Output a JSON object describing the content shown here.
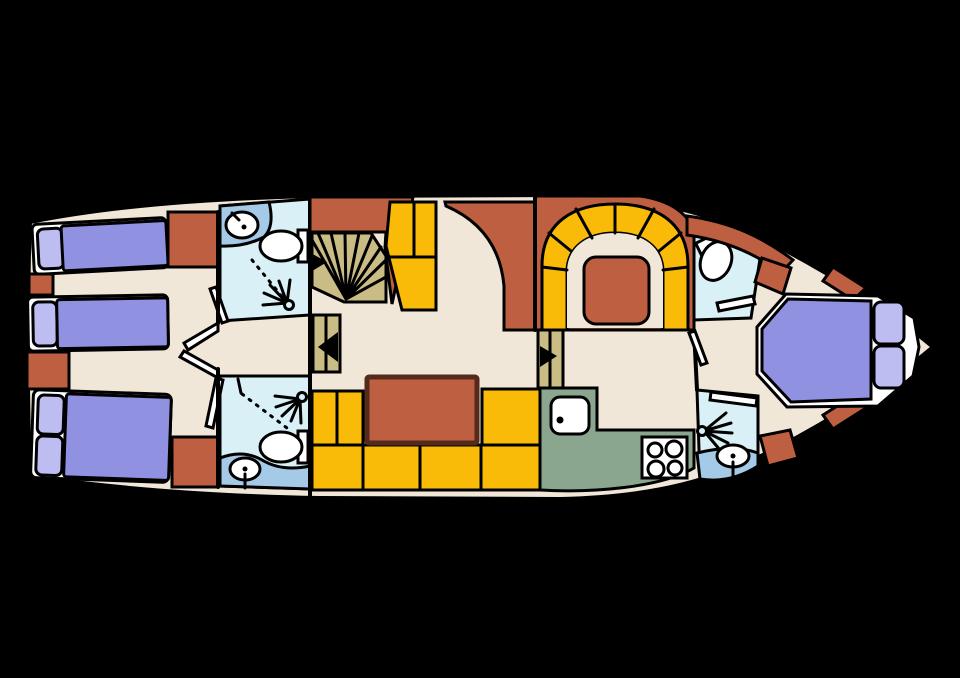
{
  "plan": {
    "type": "yacht-deck-floor-plan",
    "orientation": "bow-right",
    "rooms": [
      "aft cabin with two single berths and one double berth",
      "aft bathroom upper (sink, toilet, shower)",
      "aft bathroom lower (shower, toilet, sink)",
      "companionway stairs",
      "salon with U-sofa and table",
      "helm console",
      "dinette with horseshoe bench and table",
      "galley (sink, stove)",
      "forward bathroom upper (toilet)",
      "forward bathroom lower (shower, sink)",
      "bow cabin with double berth"
    ],
    "fixtures": [
      "bed",
      "pillow",
      "toilet",
      "sink",
      "shower-spray",
      "stove-4-burner",
      "fan-staircase",
      "step-treads",
      "door-leaf",
      "direction-arrow",
      "storage-block",
      "table"
    ]
  },
  "palette": {
    "background": "#000000",
    "outline": "#000000",
    "floor": "#f1e7d8",
    "bed": "#9191e2",
    "pillow": "#bdbdf2",
    "bed_frame": "#ffffff",
    "storage": "#bd5f40",
    "table": "#bd5f40",
    "sofa": "#f9bb07",
    "bathroom": "#d9f1f6",
    "counter": "#a4cae8",
    "galley": "#8ba68f",
    "stairs": "#c9bd85",
    "fixture": "#ffffff",
    "arrow": "#000000"
  }
}
